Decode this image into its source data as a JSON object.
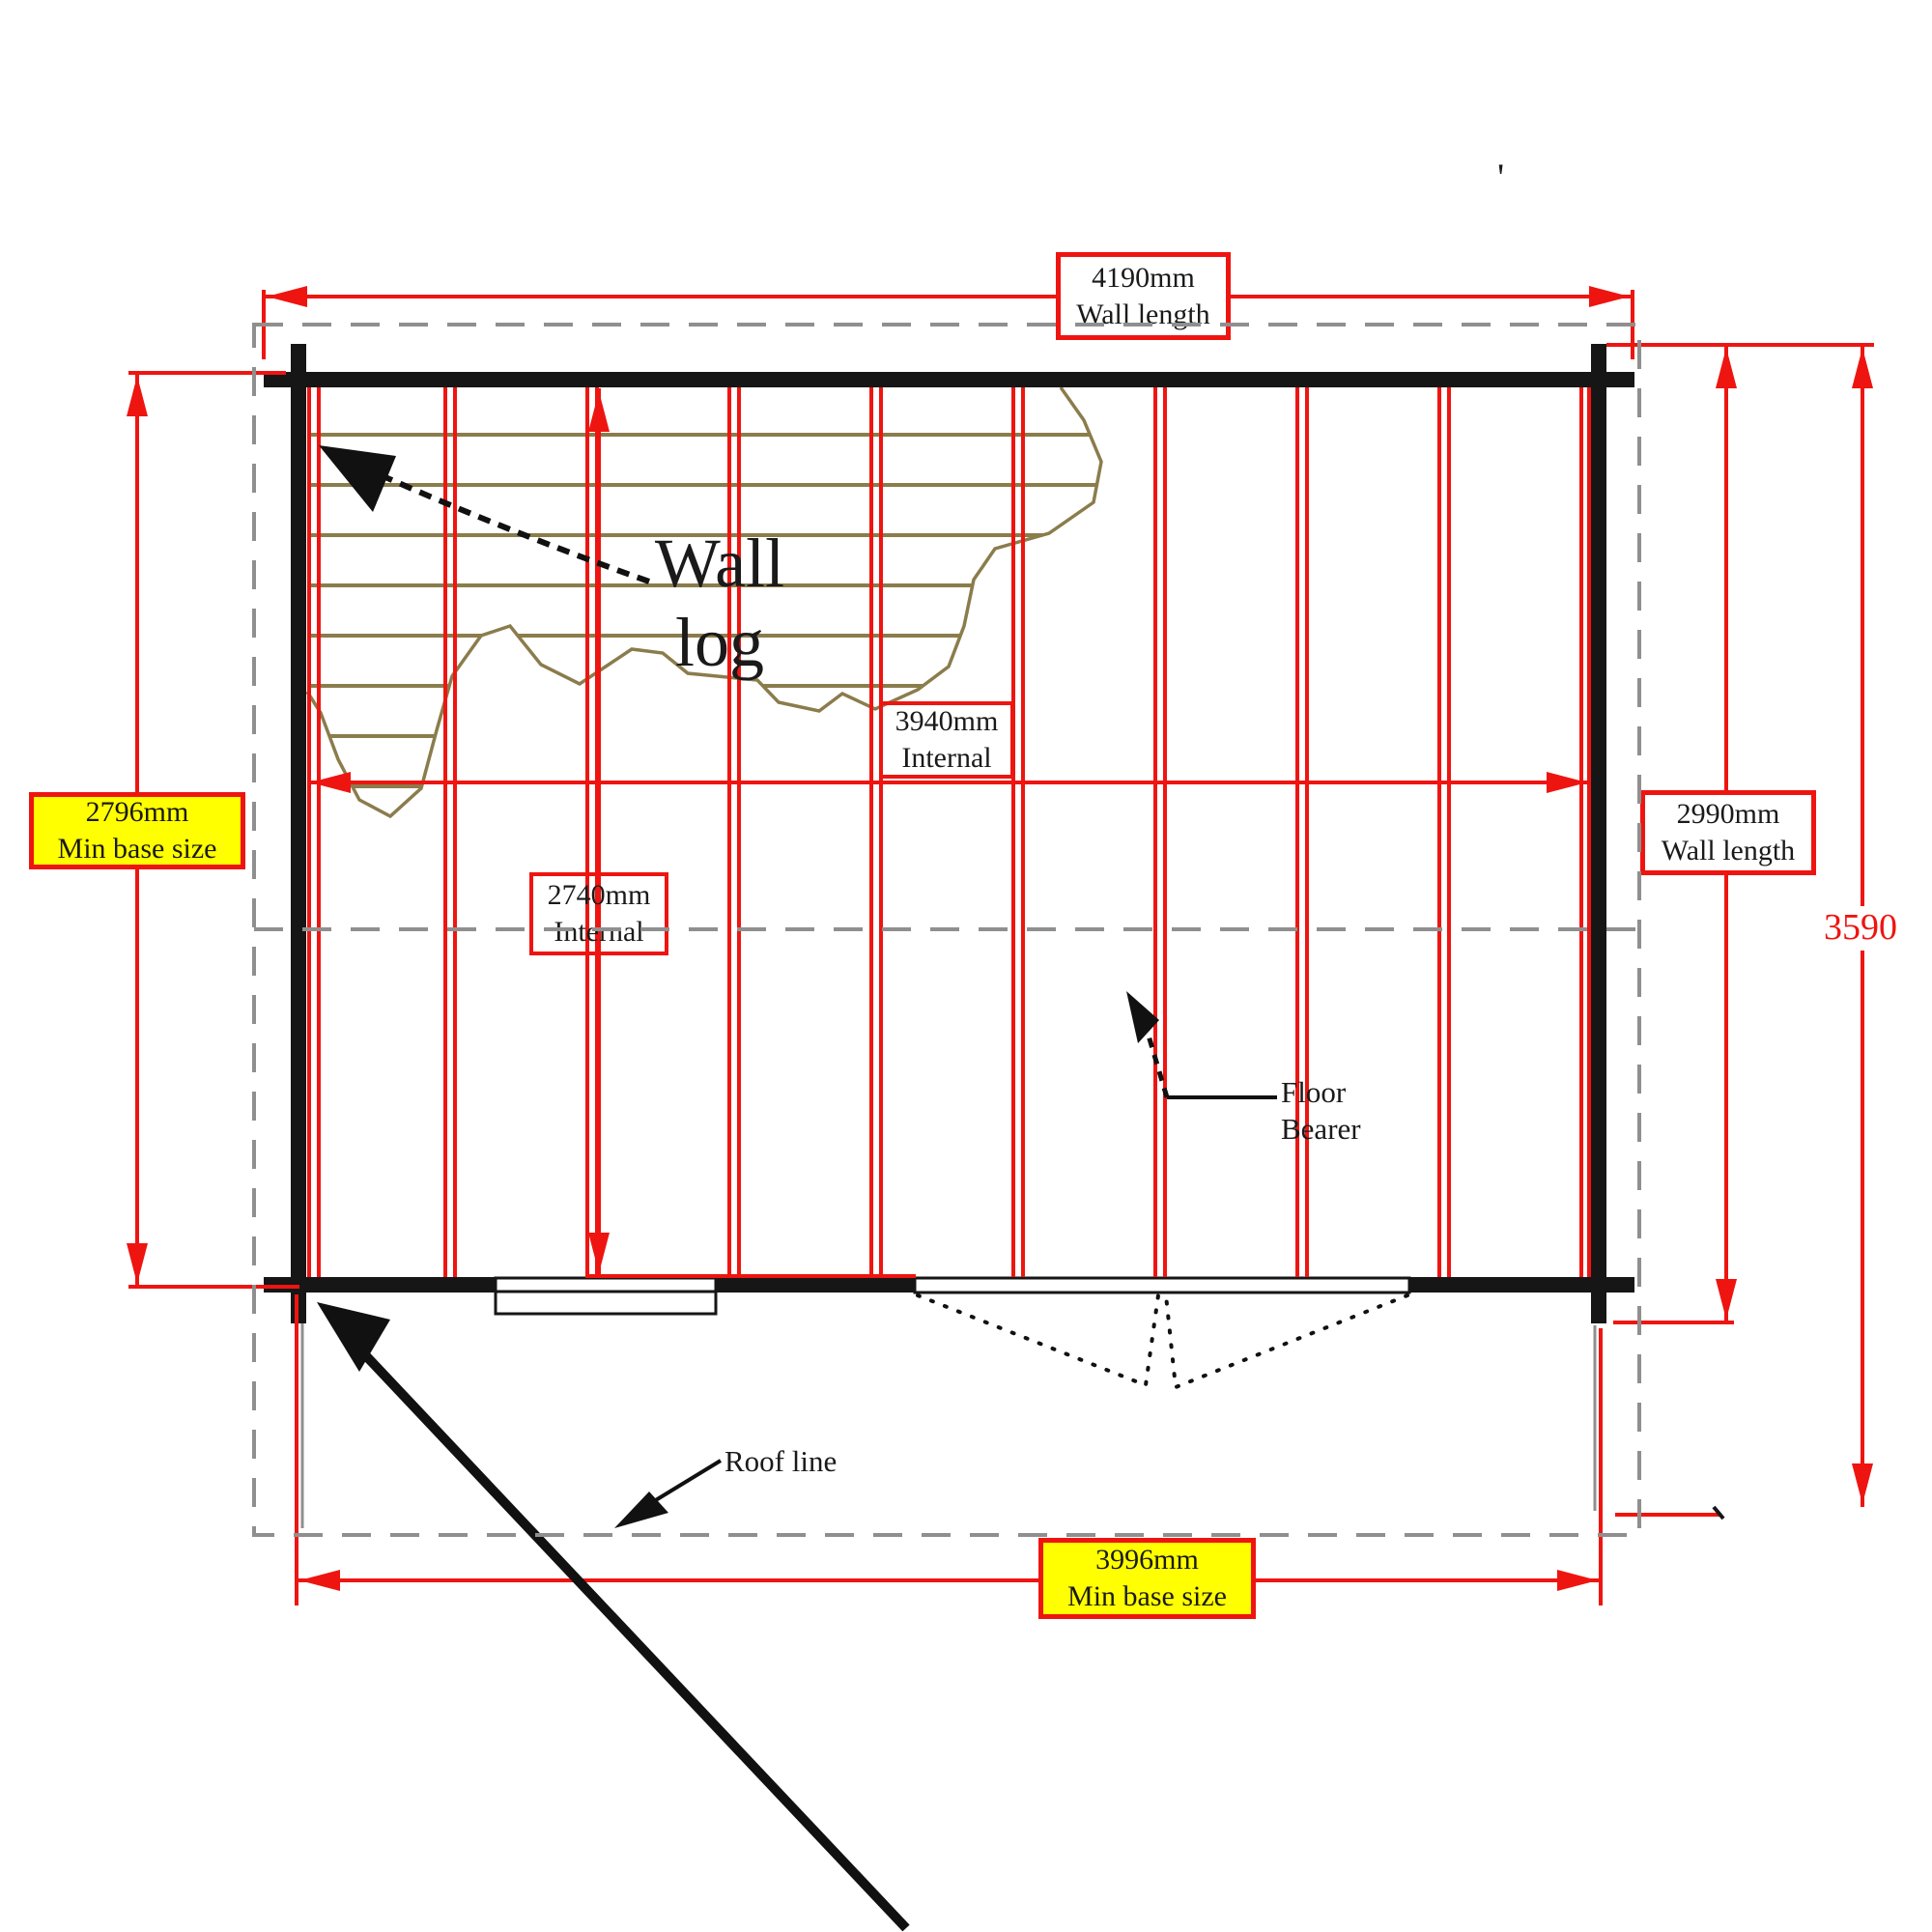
{
  "diagram": {
    "dimensions": {
      "top": {
        "value": "4190mm",
        "caption": "Wall length"
      },
      "left": {
        "value": "2796mm",
        "caption": "Min base size"
      },
      "right": {
        "value": "2990mm",
        "caption": "Wall length"
      },
      "roof_depth": "3590",
      "internal_width": {
        "value": "3940mm",
        "caption": "Internal"
      },
      "internal_depth": {
        "value": "2740mm",
        "caption": "Internal"
      },
      "bottom": {
        "value": "3996mm",
        "caption": "Min base size"
      }
    },
    "annotations": {
      "wall_log": {
        "line1": "Wall",
        "line2": "log"
      },
      "floor_bearer": {
        "line1": "Floor",
        "line2": "Bearer"
      },
      "roof_line": "Roof line",
      "stray_mark": "'"
    },
    "colors": {
      "dimension_red": "#ee1511",
      "highlight_yellow": "#ffff00",
      "wall_black": "#161616",
      "roof_gray": "#8f8f8f",
      "log_hatch": "#8b7c4c"
    }
  }
}
